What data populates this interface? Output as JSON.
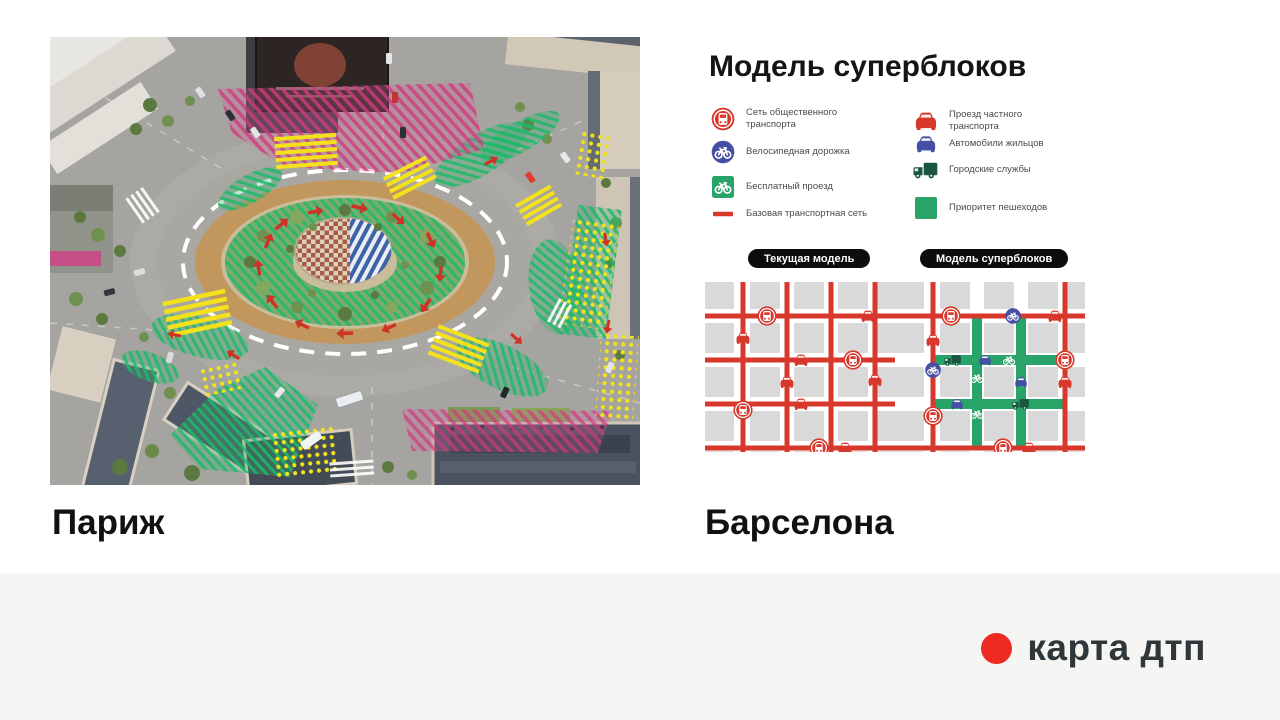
{
  "slide": {
    "title": "Модель суперблоков",
    "paris_label": "Париж",
    "barcelona_label": "Барселона"
  },
  "legend": {
    "left": [
      {
        "icon": "bus-circle",
        "label": "Сеть общественного транспорта"
      },
      {
        "icon": "bike-circle",
        "label": "Велосипедная дорожка"
      },
      {
        "icon": "bike-square",
        "label": "Бесплатный проезд"
      },
      {
        "icon": "red-line",
        "label": "Базовая транспортная сеть"
      }
    ],
    "right": [
      {
        "icon": "car-red",
        "label": "Проезд частного транспорта"
      },
      {
        "icon": "car-blue",
        "label": "Автомобили жильцов"
      },
      {
        "icon": "truck",
        "label": "Городские службы"
      },
      {
        "icon": "green-square",
        "label": "Приоритет пешеходов"
      }
    ]
  },
  "models": {
    "current": "Текущая модель",
    "superblocks": "Модель суперблоков"
  },
  "footer": {
    "brand": "карта дтп"
  },
  "colors": {
    "red": "#d8372b",
    "blue": "#4450a4",
    "green": "#29a469",
    "dark_green": "#1b5740",
    "block": "#d9d9d9",
    "pill": "#0d0d0d",
    "logo_red": "#ee2b21",
    "footer_bg": "#f5f5f4",
    "legend_text": "#4b4b4b"
  },
  "diagrams": {
    "shared": {
      "block_cx": [
        14,
        60,
        104,
        148,
        184
      ],
      "block_cy": [
        12,
        56,
        100,
        144,
        184
      ]
    },
    "current": {
      "red_v": [
        38,
        82,
        126,
        170
      ],
      "red_h": [
        34,
        78,
        122,
        166
      ],
      "green_v": [],
      "green_h": [],
      "icons": [
        {
          "t": "bus",
          "x": 62,
          "y": 34
        },
        {
          "t": "car-red",
          "x": 163,
          "y": 34
        },
        {
          "t": "car-red",
          "x": 38,
          "y": 56
        },
        {
          "t": "car-red",
          "x": 96,
          "y": 78
        },
        {
          "t": "bus",
          "x": 148,
          "y": 78
        },
        {
          "t": "car-red",
          "x": 82,
          "y": 100
        },
        {
          "t": "car-red",
          "x": 170,
          "y": 98
        },
        {
          "t": "car-red",
          "x": 96,
          "y": 122
        },
        {
          "t": "bus",
          "x": 38,
          "y": 128
        },
        {
          "t": "bus",
          "x": 114,
          "y": 166
        },
        {
          "t": "car-red",
          "x": 140,
          "y": 166
        }
      ]
    },
    "superblocks": {
      "red_v": [
        38,
        170
      ],
      "red_h": [
        34,
        166
      ],
      "green_v": [
        82,
        126
      ],
      "green_h": [
        78,
        122
      ],
      "icons": [
        {
          "t": "bus",
          "x": 56,
          "y": 34
        },
        {
          "t": "bike-circle",
          "x": 118,
          "y": 34
        },
        {
          "t": "car-red",
          "x": 160,
          "y": 34
        },
        {
          "t": "car-red",
          "x": 38,
          "y": 58
        },
        {
          "t": "truck",
          "x": 58,
          "y": 78
        },
        {
          "t": "car-blue",
          "x": 90,
          "y": 78
        },
        {
          "t": "bike-white",
          "x": 114,
          "y": 78
        },
        {
          "t": "bus",
          "x": 170,
          "y": 78
        },
        {
          "t": "bike-circle",
          "x": 38,
          "y": 88
        },
        {
          "t": "car-red",
          "x": 170,
          "y": 100
        },
        {
          "t": "car-blue",
          "x": 126,
          "y": 100
        },
        {
          "t": "car-blue",
          "x": 62,
          "y": 122
        },
        {
          "t": "truck",
          "x": 126,
          "y": 122
        },
        {
          "t": "bike-white",
          "x": 82,
          "y": 96
        },
        {
          "t": "bike-white",
          "x": 82,
          "y": 132
        },
        {
          "t": "bus",
          "x": 38,
          "y": 134
        },
        {
          "t": "bus",
          "x": 108,
          "y": 166
        },
        {
          "t": "car-red",
          "x": 134,
          "y": 166
        }
      ]
    }
  }
}
